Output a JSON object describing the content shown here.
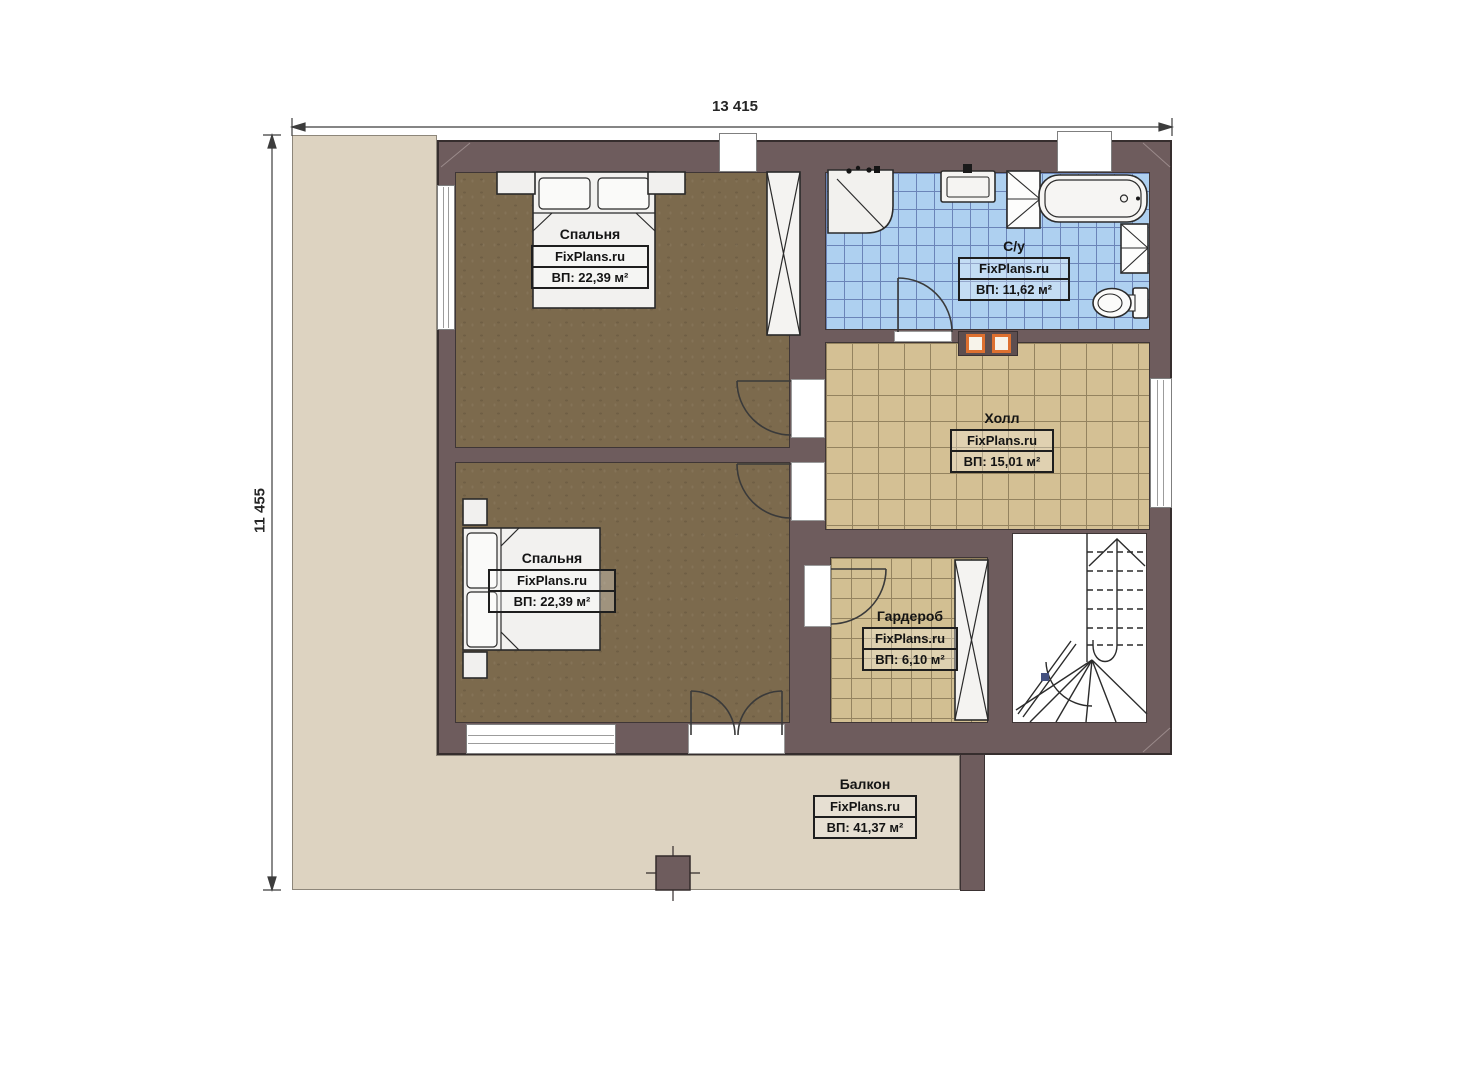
{
  "dimensions": {
    "width": "13 415",
    "height": "11 455"
  },
  "rooms": [
    {
      "id": "bedroom-top",
      "name": "Спальня",
      "brand": "FixPlans.ru",
      "area": "ВП: 22,39 м²"
    },
    {
      "id": "bathroom",
      "name": "С/у",
      "brand": "FixPlans.ru",
      "area": "ВП: 11,62 м²"
    },
    {
      "id": "hall",
      "name": "Холл",
      "brand": "FixPlans.ru",
      "area": "ВП: 15,01 м²"
    },
    {
      "id": "bedroom-bottom",
      "name": "Спальня",
      "brand": "FixPlans.ru",
      "area": "ВП: 22,39 м²"
    },
    {
      "id": "wardrobe",
      "name": "Гардероб",
      "brand": "FixPlans.ru",
      "area": "ВП: 6,10 м²"
    },
    {
      "id": "balcony",
      "name": "Балкон",
      "brand": "FixPlans.ru",
      "area": "ВП: 41,37 м²"
    }
  ],
  "colors": {
    "wall": "#6e5c5d",
    "bedroom_floor": "#7c6a4d",
    "tile_tan": "#d4c094",
    "tile_blue": "#aed0f0",
    "balcony": "#ddd3c1",
    "accent_orange": "#dd7030",
    "handrail_blue": "#44517f"
  }
}
